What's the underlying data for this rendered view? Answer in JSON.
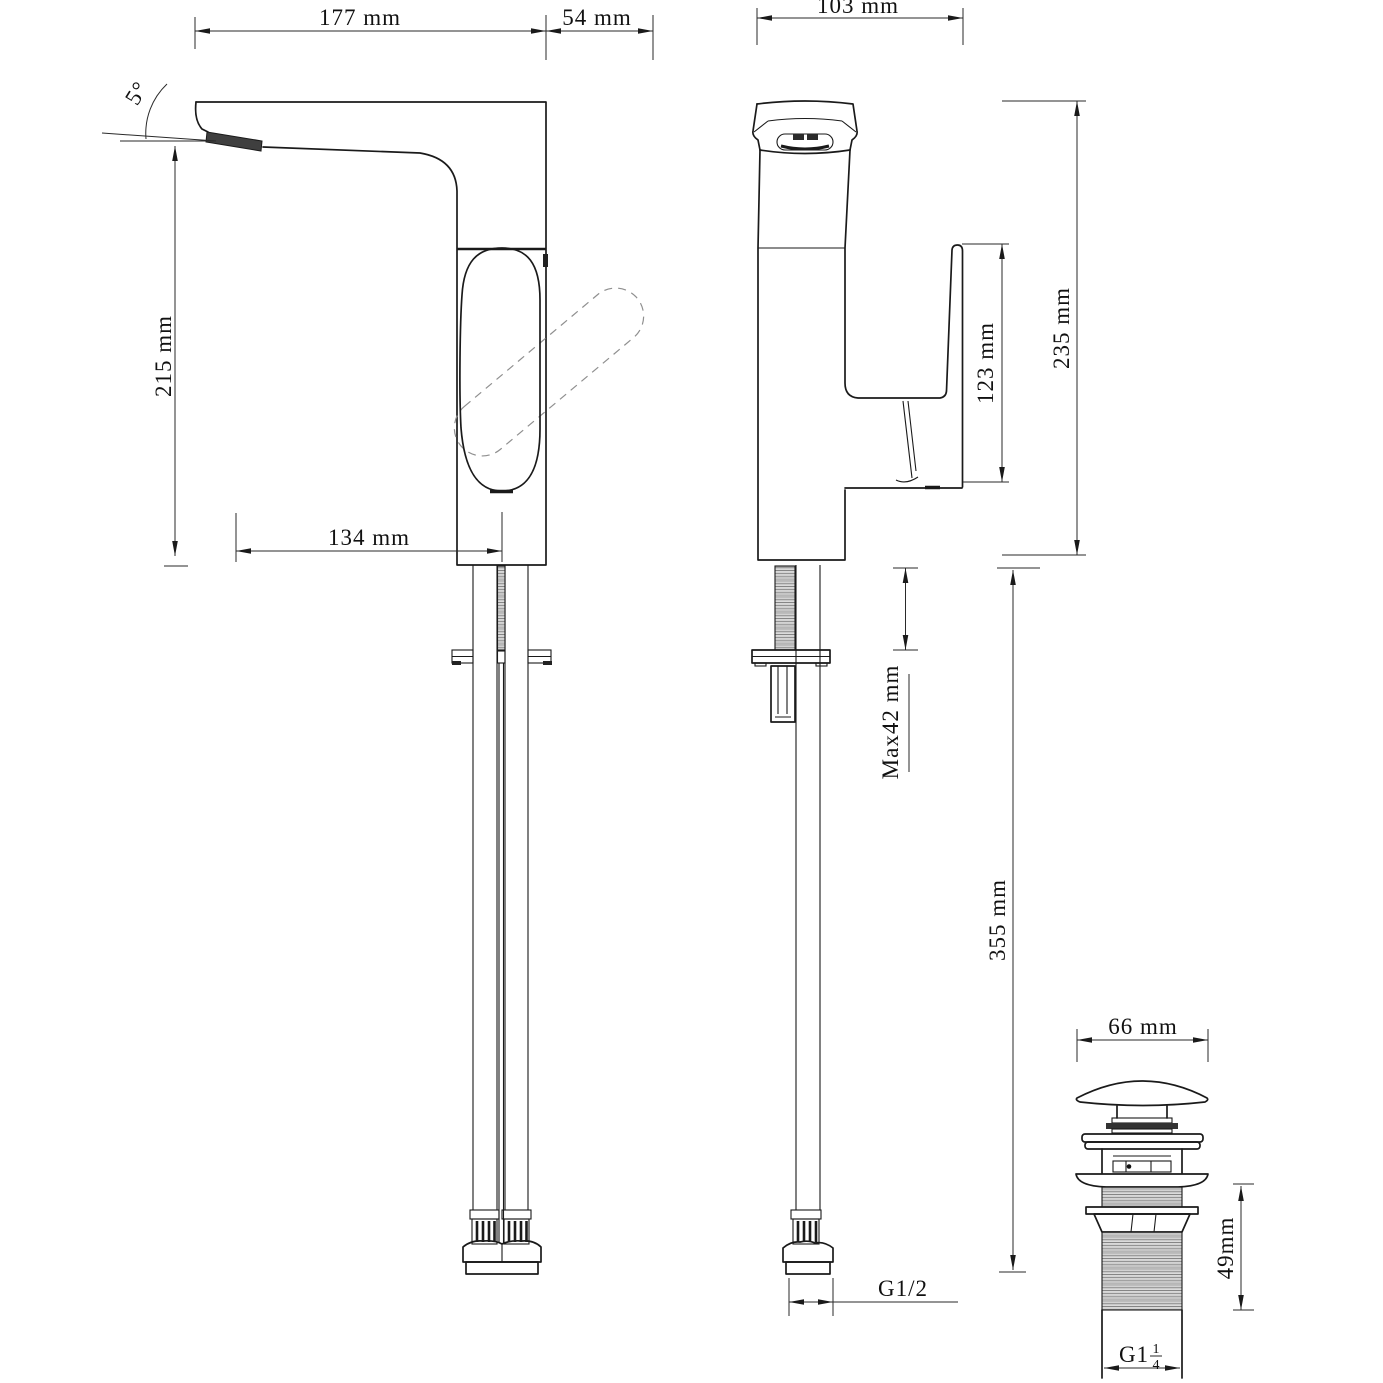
{
  "drawing": {
    "side_view": {
      "angle_label": "5°",
      "top_width": "177 mm",
      "handle_overhang": "54 mm",
      "spout_height": "215 mm",
      "spout_reach": "134 mm"
    },
    "front_view": {
      "overall_width": "103 mm",
      "handle_height": "123 mm",
      "total_height": "235 mm",
      "max_deck": "Max42 mm",
      "hose_length": "355 mm",
      "inlet_thread": "G1/2"
    },
    "drain_view": {
      "cap_diameter": "66 mm",
      "thread_length": "49mm",
      "outlet_thread_prefix": "G1",
      "outlet_thread_num": "1",
      "outlet_thread_den": "4"
    }
  }
}
